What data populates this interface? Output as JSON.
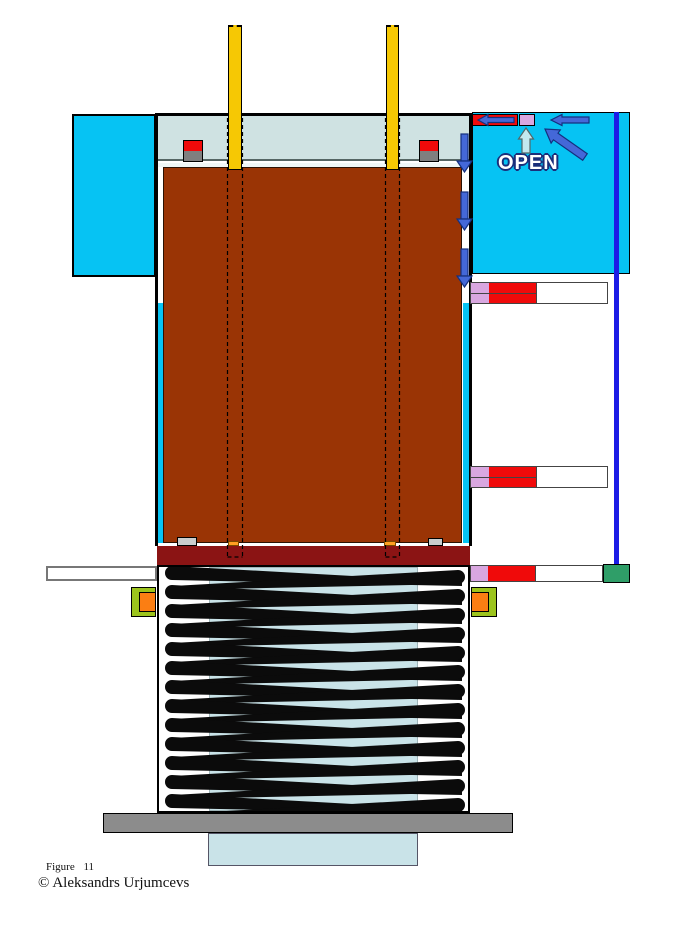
{
  "annotations": {
    "open_label": "OPEN"
  },
  "caption": {
    "figure": "Figure 11",
    "copyright": "© Aleksandrs Urjumcevs"
  },
  "colors": {
    "cyan": "#06C3F3",
    "pale_head": "#CFE2E2",
    "pale_inner": "#C9E3E8",
    "brown": "#9A3405",
    "maroon": "#8B1414",
    "yellow": "#F6C804",
    "red": "#F00A0A",
    "violet": "#D9A7E0",
    "green_block": "#2F9E68",
    "lime_green": "#9CC41D",
    "orange": "#FB7E13",
    "arrow_blue": "#4468D8",
    "line_blue": "#1C1CE6",
    "base_gray": "#8C8C8C",
    "stop_gray": "#7F7F7F"
  },
  "icons": {
    "flow_down": "down-arrow-icon",
    "flow_left": "left-arrow-icon",
    "flow_diagonal": "up-left-arrow-icon",
    "valve_open": "up-arrow-icon"
  },
  "spring": {
    "coils": 13,
    "top": 573,
    "pitch": 19,
    "left": 172,
    "right": 460,
    "drop": 11
  }
}
